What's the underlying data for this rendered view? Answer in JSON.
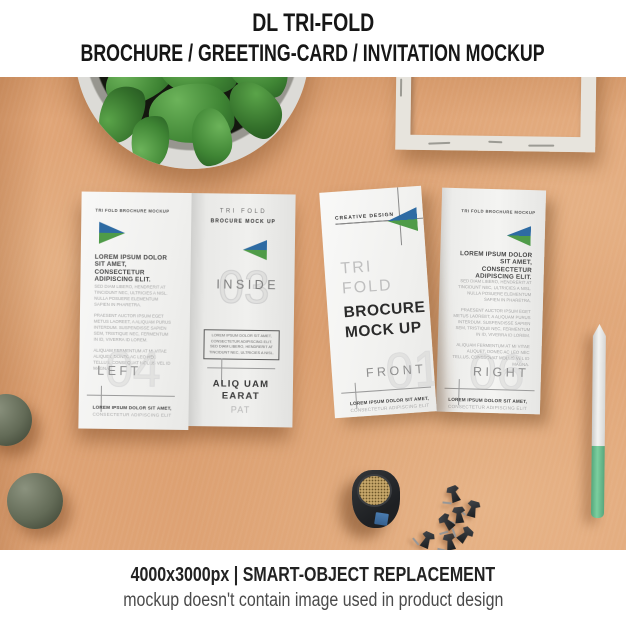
{
  "header": {
    "line1": "DL TRI-FOLD",
    "line2": "BROCHURE / GREETING-CARD / INVITATION MOCKUP"
  },
  "footer": {
    "line1": "4000x3000px | SMART-OBJECT REPLACEMENT",
    "line2": "mockup doesn't contain image used in product design"
  },
  "colors": {
    "accent_blue": "#2e6ba3",
    "accent_green": "#4f9b48",
    "background_tan": "#e0a577",
    "pen_green": "#6cc096"
  },
  "left_brochure": {
    "left_panel": {
      "brand": "TRI FOLD BROCHURE MOCKUP",
      "heading": "LOREM IPSUM DOLOR SIT AMET, CONSECTETUR ADIPISCING ELIT.",
      "para1": "SED DIAM LIBERO, HENDRERIT AT TINCIDUNT NEC, ULTRICIES A NISL. NULLA POSUERE ELEMENTUM SAPIEN IN PHARETRA.",
      "para2": "PRAESENT AUCTOR IPSUM EGET METUS LAOREET, A ALIQUAM PURUS INTERDUM. SUSPENDISSE SAPIEN SEM, TRISTIQUE NEC, FERMENTUM IN ID, VIVERRA ID LOREM.",
      "para3": "ALIQUAM FERMENTUM AT MI VITAE ALIQUET, DONEC AC LEO NEC TELLUS, CONSEQUAT MOLLIS VEL ID MAGNA.",
      "watermark": "04",
      "tab": "LEFT",
      "footer_bold": "LOREM IPSUM DOLOR SIT AMET,",
      "footer_light": "CONSECTETUR ADIPISCING ELIT"
    },
    "inside_panel": {
      "brand_light": "TRI FOLD",
      "brand_bold": "BROCURE MOCK UP",
      "tab": "INSIDE",
      "watermark": "03",
      "box_text": "LOREM IPSUM DOLOR SIT AMET, CONSECTETUR ADIPISCING ELIT. SED DIAM LIBERO, HENDRERIT AT TINCIDUNT NEC, ULTRICIES A NISL.",
      "footer_bold": "ALIQ UAM EARAT",
      "footer_light": "PAT"
    }
  },
  "right_brochure": {
    "front_panel": {
      "brand": "CREATIVE DESIGN",
      "title_light": "TRI FOLD",
      "title_bold": "BROCURE MOCK UP",
      "tab": "FRONT",
      "watermark": "01",
      "footer_bold": "LOREM IPSUM DOLOR SIT AMET,",
      "footer_light": "CONSECTETUR ADIPISCING ELIT"
    },
    "right_panel": {
      "brand": "TRI FOLD BROCHURE MOCKUP",
      "heading": "LOREM IPSUM DOLOR SIT AMET, CONSECTETUR ADIPISCING ELIT.",
      "para1": "SED DIAM LIBERO, HENDRERIT AT TINCIDUNT NEC, ULTRICIES A NISL. NULLA POSUERE ELEMENTUM SAPIEN IN PHARETRA.",
      "para2": "PRAESENT AUCTOR IPSUM EGET METUS LAOREET, A ALIQUAM PURUS INTERDUM. SUSPENDISSE SAPIEN SEM, TRISTIQUE NEC, FERMENTUM IN ID, VIVERRA ID LOREM.",
      "para3": "ALIQUAM FERMENTUM AT MI VITAE ALIQUET, DONEC AC LEO NEC TELLUS, CONSEQUAT MOLLIS VEL ID MAGNA.",
      "tab": "RIGHT",
      "watermark": "06",
      "footer_bold": "LOREM IPSUM DOLOR SIT AMET,",
      "footer_light": "CONSECTETUR ADIPISCING ELIT"
    }
  }
}
